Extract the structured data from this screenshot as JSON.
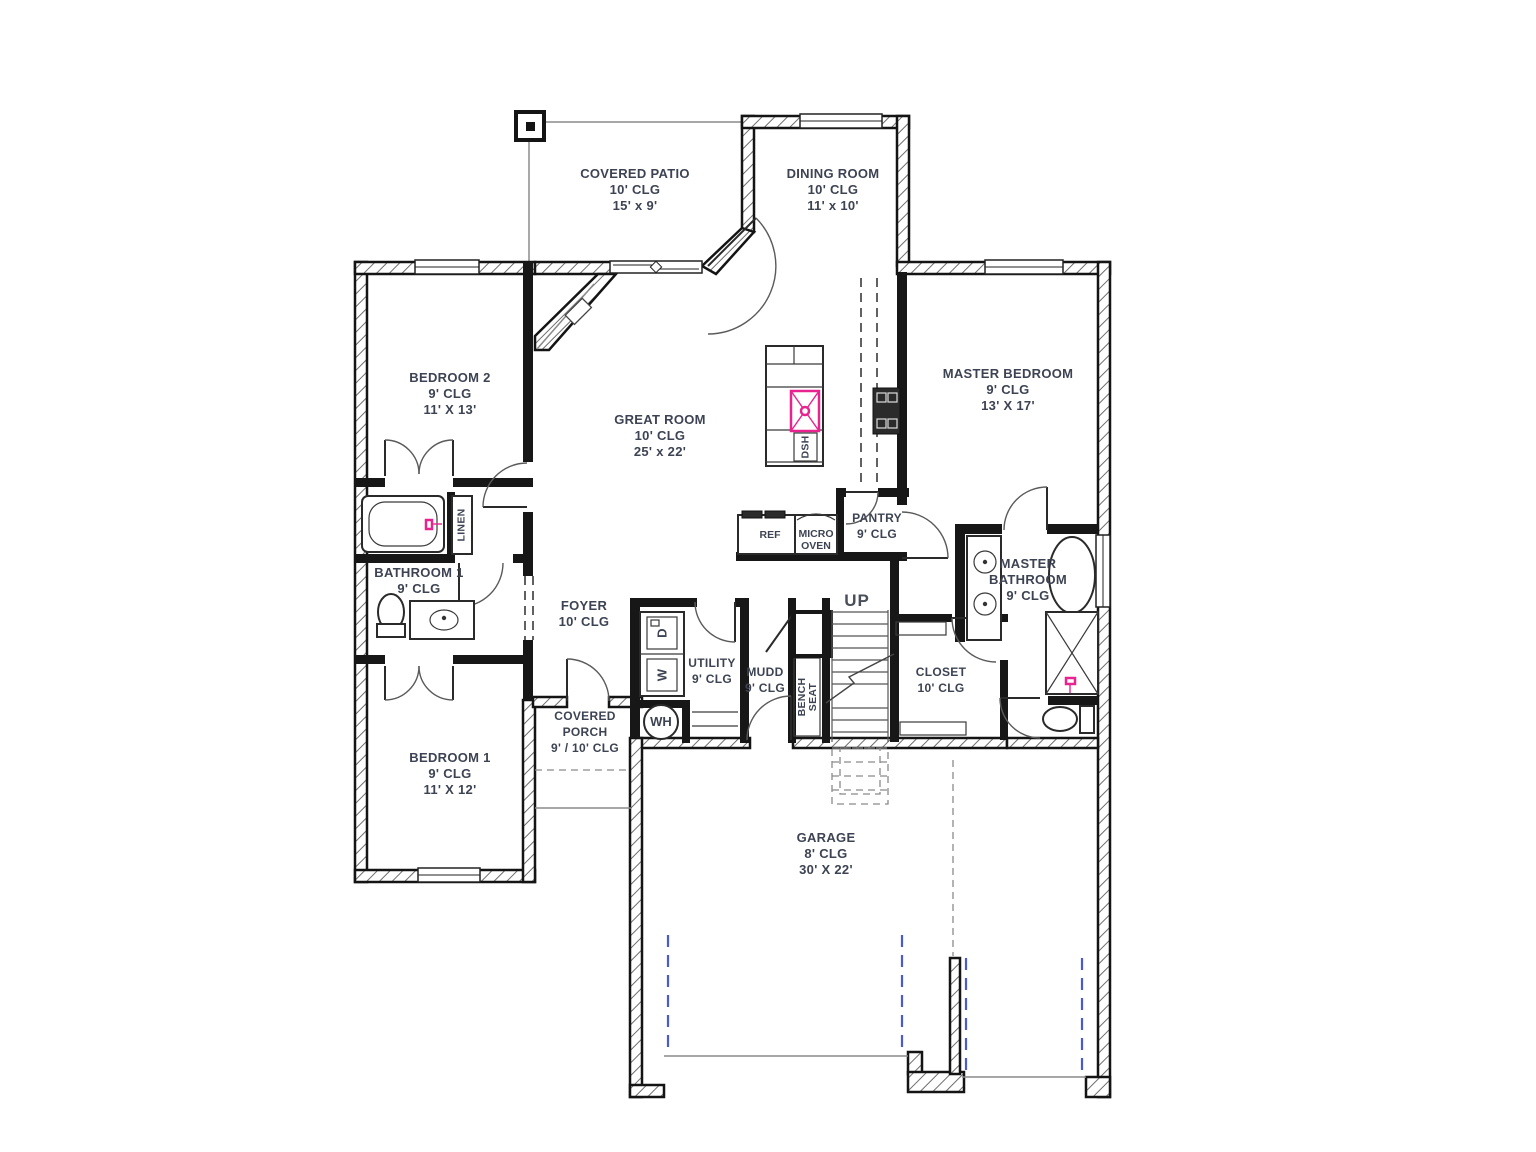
{
  "rooms": {
    "covered_patio": {
      "name": "COVERED PATIO",
      "ceiling": "10' CLG",
      "size": "15' x 9'"
    },
    "dining_room": {
      "name": "DINING ROOM",
      "ceiling": "10' CLG",
      "size": "11' x 10'"
    },
    "bedroom_2": {
      "name": "BEDROOM 2",
      "ceiling": "9' CLG",
      "size": "11' X 13'"
    },
    "great_room": {
      "name": "GREAT ROOM",
      "ceiling": "10' CLG",
      "size": "25' x 22'"
    },
    "master_bedroom": {
      "name": "MASTER BEDROOM",
      "ceiling": "9' CLG",
      "size": "13' X 17'"
    },
    "bathroom_1": {
      "name": "BATHROOM 1",
      "ceiling": "9' CLG"
    },
    "foyer": {
      "name": "FOYER",
      "ceiling": "10' CLG"
    },
    "utility": {
      "name": "UTILITY",
      "ceiling": "9' CLG"
    },
    "mudd": {
      "name": "MUDD",
      "ceiling": "9' CLG"
    },
    "pantry": {
      "name": "PANTRY",
      "ceiling": "9' CLG"
    },
    "master_bathroom": {
      "name": "MASTER BATHROOM",
      "ceiling": "9' CLG"
    },
    "closet": {
      "name": "CLOSET",
      "ceiling": "10' CLG"
    },
    "bedroom_1": {
      "name": "BEDROOM 1",
      "ceiling": "9' CLG",
      "size": "11' X 12'"
    },
    "covered_porch": {
      "name": "COVERED PORCH",
      "ceiling": "9' / 10' CLG"
    },
    "garage": {
      "name": "GARAGE",
      "ceiling": "8' CLG",
      "size": "30' X 22'"
    }
  },
  "fixtures": {
    "linen": "LINEN",
    "dishwasher": "DSH",
    "refrigerator": "REF",
    "microwave": "MICRO OVEN",
    "washer": "W",
    "dryer": "D",
    "water_heater": "WH",
    "bench_seat": "BENCH SEAT",
    "stairs_direction": "UP"
  },
  "colors": {
    "accent_pink": "#e8238f",
    "accent_blue": "#4a5ad0",
    "wall": "#171717",
    "label_text": "#3d4352",
    "line_gray": "#8a8a8a"
  }
}
